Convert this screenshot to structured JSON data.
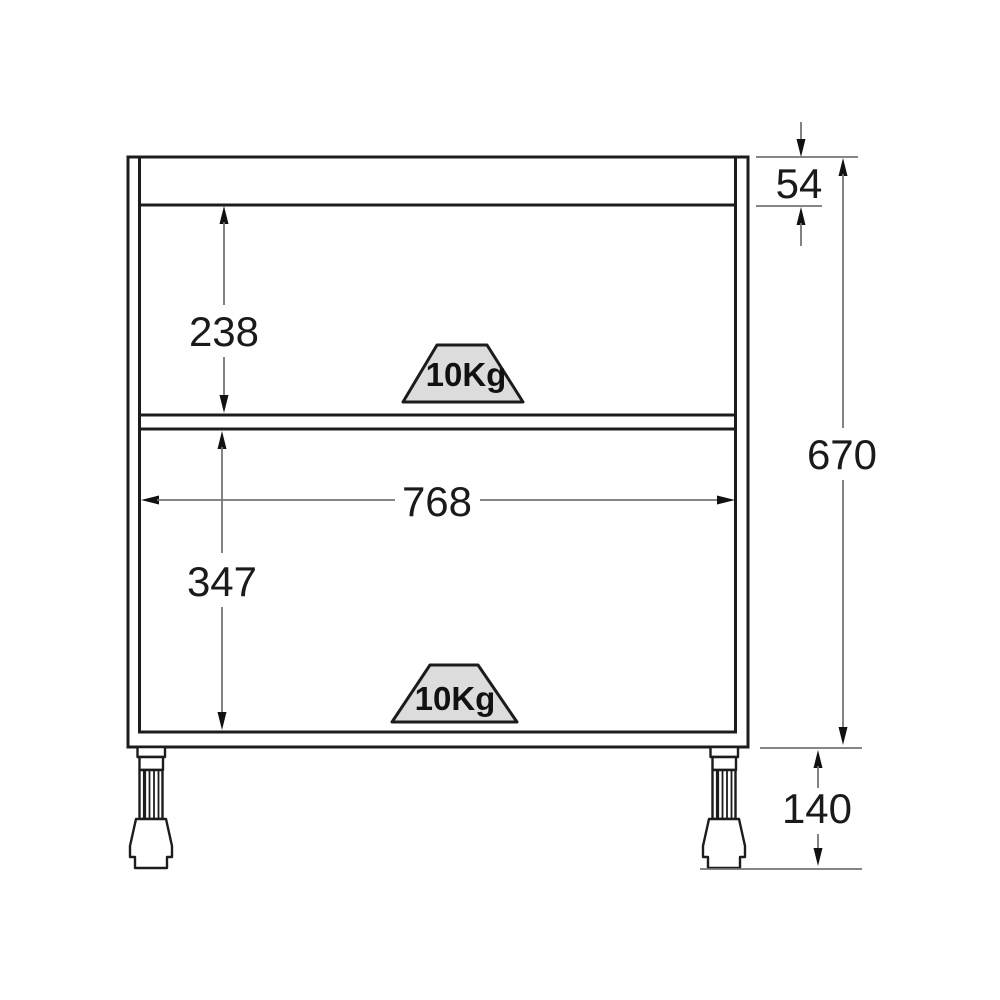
{
  "drawing": {
    "dimensions": {
      "top_rail_height": "54",
      "upper_opening_height": "238",
      "lower_opening_height": "347",
      "inner_width": "768",
      "cabinet_height": "670",
      "leg_height": "140"
    },
    "load_badges": {
      "upper": "10Kg",
      "lower": "10Kg"
    },
    "colors": {
      "outline": "#1c1c1c",
      "dimension_line": "#757575",
      "arrowhead": "#111111",
      "badge_fill": "#dcdcdc",
      "background": "#ffffff"
    }
  }
}
